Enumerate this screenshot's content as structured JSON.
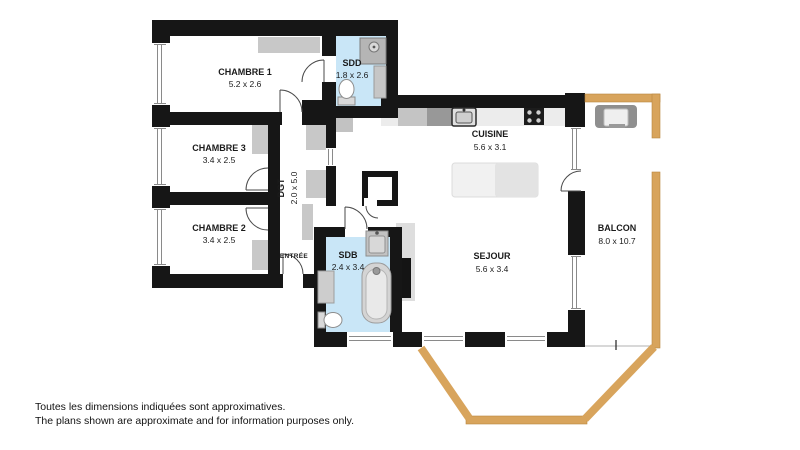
{
  "plan": {
    "rooms": {
      "chambre1": {
        "name": "CHAMBRE 1",
        "dims": "5.2 x 2.6"
      },
      "chambre3": {
        "name": "CHAMBRE 3",
        "dims": "3.4 x 2.5"
      },
      "chambre2": {
        "name": "CHAMBRE 2",
        "dims": "3.4 x 2.5"
      },
      "sdd": {
        "name": "SDD",
        "dims": "1.8 x 2.6"
      },
      "dgt": {
        "name": "DGT",
        "dims": "2.0 x 5.0"
      },
      "entree": {
        "name": "ENTRÉE"
      },
      "sdb": {
        "name": "SDB",
        "dims": "2.4 x 3.4"
      },
      "cuisine": {
        "name": "CUISINE",
        "dims": "5.6 x 3.1"
      },
      "sejour": {
        "name": "SEJOUR",
        "dims": "5.6 x 3.4"
      },
      "balcon": {
        "name": "BALCON",
        "dims": "8.0 x 10.7"
      }
    },
    "colors": {
      "wall": "#161616",
      "bathroom_blue": "#c9e6f7",
      "wood_railing": "#d8a45c",
      "furniture_gray": "#c8c8c8"
    },
    "disclaimer": {
      "line1": "Toutes les dimensions indiquées sont approximatives.",
      "line2": "The plans shown are approximate and for information purposes only."
    }
  }
}
